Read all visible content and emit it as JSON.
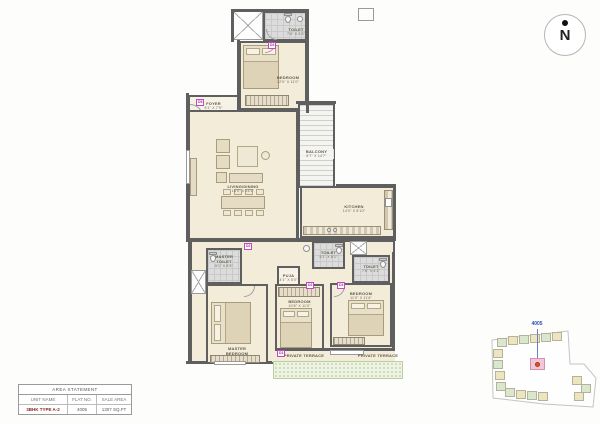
{
  "north_label": "N",
  "rooms": {
    "toilet_top": {
      "name": "TOILET",
      "dims": "7'6\" X 5'3\""
    },
    "bedroom_top": {
      "name": "BEDROOM",
      "dims": "12'0\" X 11'0\""
    },
    "foyer": {
      "name": "FOYER",
      "dims": "5'1\" X 7'9\""
    },
    "living_dining": {
      "name": "LIVING/DINING",
      "dims": "16'0\" X 24'1\""
    },
    "balcony": {
      "name": "BALCONY",
      "dims": "6'7\" X 14'7\""
    },
    "kitchen": {
      "name": "KITCHEN",
      "dims": "14'0\" X 8'10\""
    },
    "master_toilet": {
      "name": "MASTER TOILET",
      "dims": "5'1\" X 8'5\""
    },
    "master_bedroom": {
      "name": "MASTER BEDROOM",
      "dims": "11'6\" X 20'1\""
    },
    "puja": {
      "name": "PUJA",
      "dims": "4'1\" X 5'0\""
    },
    "toilet_mid": {
      "name": "TOILET",
      "dims": "5'1\" X 8'1\""
    },
    "bedroom_mid": {
      "name": "BEDROOM",
      "dims": "10'6\" X 11'0\""
    },
    "toilet_right": {
      "name": "TOILET",
      "dims": "7'6\" X 4'1\""
    },
    "bedroom_right": {
      "name": "BEDROOM",
      "dims": "11'0\" X 11'6\""
    },
    "terrace_left": {
      "name": "PRIVATE TERRACE"
    },
    "terrace_right": {
      "name": "PRIVATE TERRACE"
    }
  },
  "door_tags": [
    "D5",
    "D4",
    "D2",
    "D2",
    "D3",
    "D1"
  ],
  "area_statement": {
    "title": "AREA STATEMENT",
    "columns": [
      "UNIT NAME",
      "FLAT NO.",
      "SALE AREA"
    ],
    "row": {
      "unit_name": "3BHK TYPE A-2",
      "flat_no": "4005",
      "sale_area": "1307 SQ.FT"
    }
  },
  "key_plan": {
    "flat_label": "4005"
  },
  "colors": {
    "wall": "#5f5f5f",
    "floor_beige": "#f2ecd9",
    "toilet_gray": "#dcdcdc",
    "tag_magenta": "#c249c2",
    "terrace_green": "#eef3e4",
    "keyplan_yellow": "#ece5bd",
    "keyplan_green": "#d9e7cc",
    "highlight_pink": "#f3c7d9",
    "locator_dot_red": "#e0561e",
    "flat_label_blue": "#2f4fae",
    "unit_name_maroon": "#8a1f1f"
  }
}
